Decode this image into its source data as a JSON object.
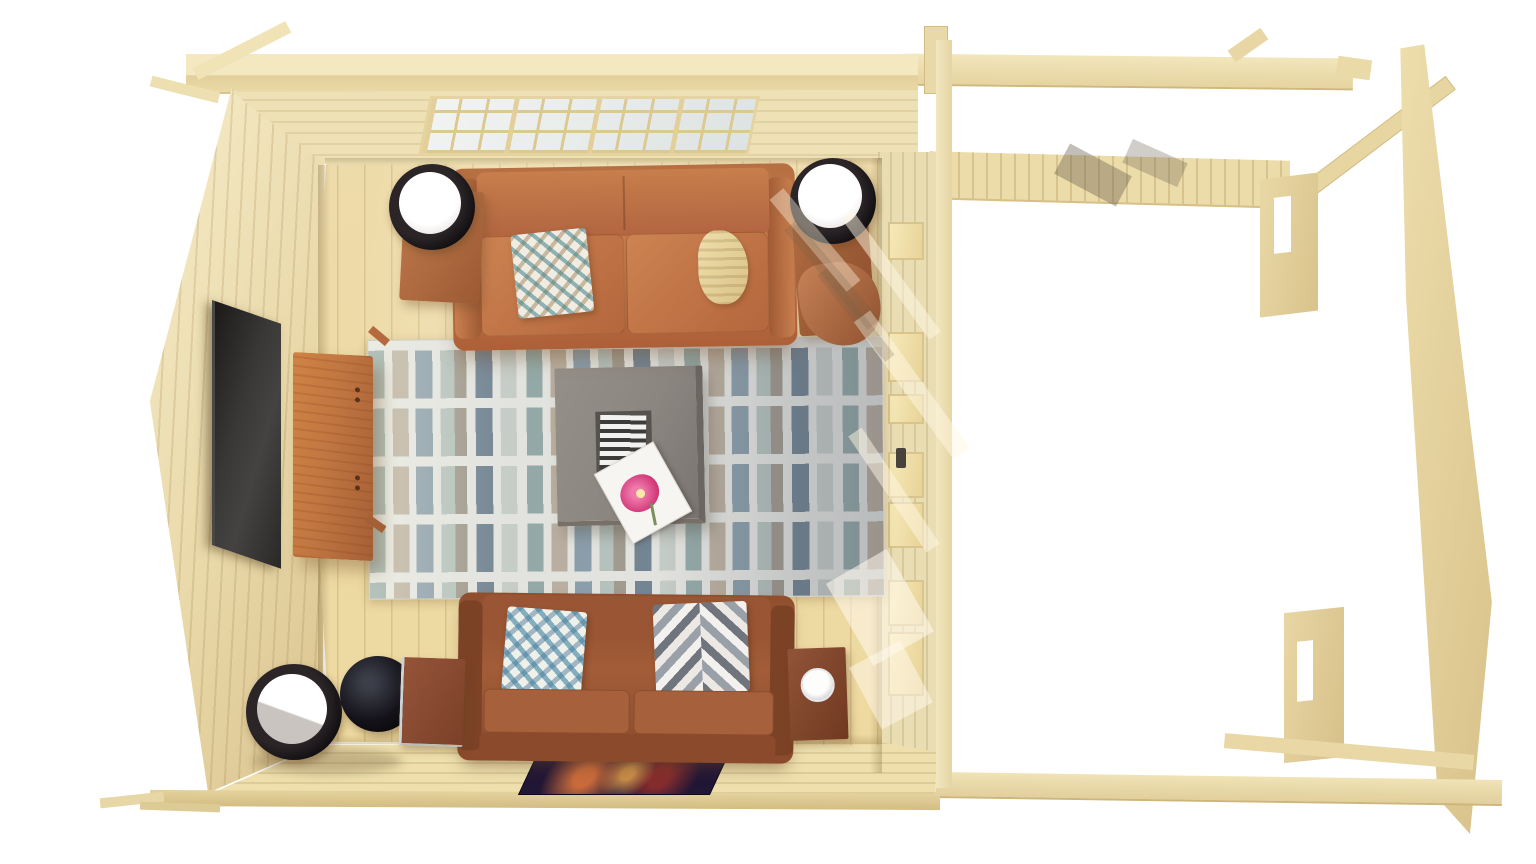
{
  "scene": {
    "type": "3d-architectural-render",
    "view": "top-down bird's-eye view",
    "setting": "log cabin living room interior with adjoining open pergola porch framing",
    "background_color": "#ffffff",
    "primary_wood_color": "#ecd9a4"
  },
  "room": {
    "floor": {
      "label": "light pine plank floor",
      "color": "#ecd9a4"
    },
    "left_wall": {
      "label": "gable end wall",
      "color": "#eee3bc"
    },
    "top_wall": {
      "label": "wall with wide glazing band",
      "window": {
        "label": "multi-pane window",
        "columns": 12,
        "rows": 3,
        "pane_color": "#e9edec",
        "frame_color": "#dcc992"
      }
    },
    "right_wall": {
      "label": "glazed door and window wall",
      "pane_color": "#f2e5ad",
      "door_handle_color": "#49433b"
    },
    "bottom_wall": {
      "label": "wall with artwork",
      "artwork": {
        "label": "dark abstract picture",
        "base_color": "#221636",
        "accent_colors": [
          "#e67a3c",
          "#f9b450",
          "#c83c28"
        ]
      }
    }
  },
  "furniture": {
    "upper_sofa": {
      "label": "cognac leather two-seat sofa",
      "color": "#c07848",
      "items": [
        {
          "label": "diamond-pattern accent pillow",
          "colors": [
            "#f0ece2",
            "#3d828c",
            "#a08054"
          ]
        },
        {
          "label": "cream knit throw",
          "color": "#e9d9a6"
        }
      ],
      "side_tables": [
        {
          "label": "wood side table with cylinder lamp",
          "table_color": "#b5754a",
          "lamp_color": "#1d1a1c"
        },
        {
          "label": "wood side table with cylinder lamp and copper basket",
          "table_color": "#a9693f",
          "basket_color": "#b0714f"
        }
      ]
    },
    "lower_sofa": {
      "label": "brown leather two-seat sofa",
      "color": "#a05a38",
      "items": [
        {
          "label": "teal diamond-pattern pillow",
          "colors": [
            "#eef0ea",
            "#3c82a0"
          ]
        },
        {
          "label": "chevron-pattern pillow",
          "colors": [
            "#70747c",
            "#ece9e5"
          ]
        }
      ],
      "left_side": {
        "floor_lamp": {
          "label": "black cylinder floor lamp with glowing shade",
          "color": "#17141a"
        },
        "sphere": {
          "label": "black decor sphere"
        },
        "table": {
          "label": "small metal-frame side table",
          "color": "#8a4a33"
        }
      },
      "right_side": {
        "table": {
          "label": "small dark wood table with white plate",
          "color": "#8a4f38",
          "plate_color": "#f4f4f5"
        }
      }
    },
    "rug": {
      "label": "ivory area rug with painted stripe rows",
      "base_color": "#e2e3df",
      "stripe_colors": [
        "#7a9694",
        "#a89884",
        "#6e8698",
        "#96aaa5",
        "#7d7364",
        "#546a7e",
        "#afb9b4"
      ]
    },
    "coffee_table": {
      "label": "square gray coffee table",
      "color": "#8b8680",
      "items": [
        {
          "label": "black-and-white striped magazine in recessed tray"
        },
        {
          "label": "white magazine with pink flower cover",
          "flower_color": "#d13677"
        }
      ]
    },
    "tv": {
      "label": "wall-mounted flat TV",
      "color": "#35312e"
    },
    "media_console": {
      "label": "orange wood media console",
      "color": "#c17641"
    }
  },
  "pergola": {
    "label": "unfinished open porch roof framing",
    "wood_color": "#ecdcaa",
    "parts": [
      "long top beam",
      "ceiling joist band",
      "sloped rafter",
      "tapered gable edge plank",
      "slotted corner posts",
      "bottom beams"
    ]
  },
  "lighting": {
    "sunlight": "diagonal sun streaks across door wall and floor",
    "shadows": "soft furniture shadows and joist shadows"
  }
}
